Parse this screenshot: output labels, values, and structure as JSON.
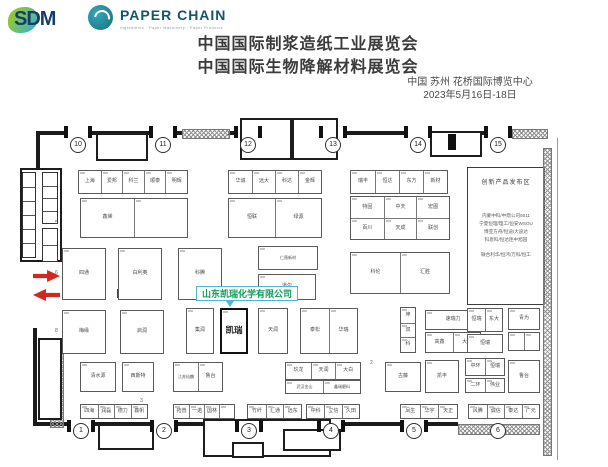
{
  "header": {
    "logo_sdm": {
      "text": "SDM"
    },
    "logo_paperchain": {
      "name": "PAPER CHAIN",
      "tagline": "Ingredients · Paper Machinery · Paper Products"
    },
    "title_line1": "中国国际制浆造纸工业展览会",
    "title_line2": "中国国际生物降解材料展览会",
    "venue": "中国 苏州 花桥国际博览中心",
    "dates": "2023年5月16日-18日"
  },
  "floorplan": {
    "highlight": {
      "callout": "山东凯瑞化学有限公司",
      "booth": "凯瑞",
      "accent_border": "#4fb6d9",
      "accent_text": "#0e9d58",
      "arrow_color": "#d2281e"
    },
    "launch_area": {
      "title": "创新产品发布区",
      "lines": [
        "内蒙中科/中鼎公司5011",
        "宁夏恒理/理工/恒安WSOU",
        "博亚方舟/恒迪/大迪达",
        "科恩科/恒达连中旭园",
        "联合利华/恒鸿/万科/恒工"
      ]
    },
    "gates_top": [
      {
        "n": "10",
        "x": 77
      },
      {
        "n": "11",
        "x": 162
      },
      {
        "n": "12",
        "x": 247
      },
      {
        "n": "13",
        "x": 332
      },
      {
        "n": "14",
        "x": 417
      },
      {
        "n": "15",
        "x": 497
      }
    ],
    "gates_bottom": [
      {
        "n": "1",
        "x": 80
      },
      {
        "n": "2",
        "x": 163
      },
      {
        "n": "3",
        "x": 248
      },
      {
        "n": "4",
        "x": 330
      },
      {
        "n": "5",
        "x": 413
      },
      {
        "n": "6",
        "x": 497
      }
    ],
    "gate_y_top": 34,
    "gate_y_bottom": 320,
    "walls": [
      [
        36,
        21,
        28,
        4
      ],
      [
        90,
        21,
        59,
        4
      ],
      [
        175,
        21,
        7,
        4
      ],
      [
        228,
        21,
        6,
        4
      ],
      [
        260,
        21,
        59,
        4
      ],
      [
        345,
        21,
        59,
        4
      ],
      [
        430,
        21,
        54,
        4
      ],
      [
        36,
        21,
        4,
        102
      ],
      [
        33,
        218,
        4,
        98
      ],
      [
        36,
        312,
        31,
        4
      ],
      [
        93,
        312,
        57,
        4
      ],
      [
        176,
        312,
        59,
        4
      ],
      [
        261,
        312,
        56,
        4
      ],
      [
        343,
        312,
        57,
        4
      ],
      [
        426,
        312,
        32,
        4
      ]
    ],
    "hatches": [
      [
        182,
        19,
        46,
        8
      ],
      [
        512,
        19,
        34,
        8
      ],
      [
        458,
        314,
        80,
        9
      ],
      [
        543,
        38,
        7,
        306
      ],
      [
        50,
        242,
        12,
        74
      ]
    ],
    "rooms": [
      [
        96,
        23,
        52,
        28
      ],
      [
        240,
        8,
        52,
        42
      ],
      [
        292,
        8,
        46,
        42
      ],
      [
        430,
        21,
        52,
        26
      ],
      [
        98,
        314,
        56,
        26
      ],
      [
        203,
        309,
        128,
        38
      ],
      [
        232,
        332,
        32,
        16
      ],
      [
        283,
        319,
        58,
        22
      ],
      [
        20,
        58,
        42,
        94
      ],
      [
        38,
        228,
        24,
        82
      ]
    ],
    "cellstructs": [
      {
        "x": 22,
        "y": 62,
        "w": 14,
        "h": 86,
        "rows": 6
      },
      {
        "x": 42,
        "y": 62,
        "w": 16,
        "h": 52,
        "rows": 4
      },
      {
        "x": 42,
        "y": 118,
        "w": 16,
        "h": 34,
        "rows": 2
      }
    ],
    "top_pier_xs": [
      64,
      88,
      149,
      173,
      234,
      258,
      319,
      343,
      404,
      428,
      484,
      508
    ],
    "bottom_pier_xs": [
      67,
      91,
      150,
      174,
      235,
      259,
      317,
      341,
      400,
      424
    ],
    "blocks": [
      [
        448,
        24,
        8,
        16
      ]
    ],
    "tiny_squares": [
      [
        117,
        179,
        11,
        9
      ],
      [
        237,
        180,
        11,
        9
      ]
    ],
    "rowmarks": [
      {
        "x": 55,
        "y": 110,
        "t": "5"
      },
      {
        "x": 55,
        "y": 160,
        "t": "6"
      },
      {
        "x": 55,
        "y": 218,
        "t": "8"
      },
      {
        "x": 140,
        "y": 288,
        "t": "3"
      },
      {
        "x": 370,
        "y": 250,
        "t": "2"
      }
    ],
    "booths": [
      {
        "x": 78,
        "y": 60,
        "w": 110,
        "h": 24,
        "cols": 5,
        "labels": [
          "上海",
          "爱邦",
          "科兰",
          "顺泰",
          "明辉"
        ]
      },
      {
        "x": 228,
        "y": 60,
        "w": 94,
        "h": 24,
        "cols": 4,
        "labels": [
          "华诚",
          "远大",
          "科达",
          "金辉"
        ]
      },
      {
        "x": 350,
        "y": 60,
        "w": 98,
        "h": 24,
        "cols": 4,
        "labels": [
          "瑞丰",
          "恒达",
          "东方",
          "新材"
        ]
      },
      {
        "x": 80,
        "y": 88,
        "w": 108,
        "h": 40,
        "cols": 2,
        "labels": [
          "鑫烯",
          ""
        ]
      },
      {
        "x": 228,
        "y": 88,
        "w": 94,
        "h": 40,
        "cols": 2,
        "labels": [
          "恒联",
          "绿源"
        ]
      },
      {
        "x": 350,
        "y": 86,
        "w": 100,
        "h": 44,
        "cols": 3,
        "rows": 2,
        "labels": [
          "特固",
          "中天",
          "宏图",
          "百川",
          "天成",
          "联创"
        ]
      },
      {
        "x": 62,
        "y": 138,
        "w": 44,
        "h": 52,
        "labels": [
          "四通"
        ]
      },
      {
        "x": 118,
        "y": 138,
        "w": 44,
        "h": 52,
        "labels": [
          "白利奥"
        ]
      },
      {
        "x": 178,
        "y": 138,
        "w": 44,
        "h": 52,
        "labels": [
          "科腾"
        ]
      },
      {
        "x": 258,
        "y": 136,
        "w": 60,
        "h": 24,
        "labels": [
          "仁薇新材"
        ]
      },
      {
        "x": 258,
        "y": 164,
        "w": 58,
        "h": 26,
        "labels": [
          "道尔"
        ]
      },
      {
        "x": 350,
        "y": 142,
        "w": 100,
        "h": 42,
        "cols": 2,
        "labels": [
          "科伦",
          "汇胜"
        ]
      },
      {
        "x": 62,
        "y": 200,
        "w": 44,
        "h": 44,
        "labels": [
          "梅缘"
        ]
      },
      {
        "x": 120,
        "y": 200,
        "w": 44,
        "h": 44,
        "labels": [
          "启润"
        ]
      },
      {
        "x": 186,
        "y": 198,
        "w": 28,
        "h": 46,
        "labels": [
          "集润"
        ]
      },
      {
        "x": 220,
        "y": 198,
        "w": 28,
        "h": 46,
        "bold": true,
        "labels": [
          "凯瑞"
        ]
      },
      {
        "x": 258,
        "y": 198,
        "w": 30,
        "h": 46,
        "labels": [
          "天润"
        ]
      },
      {
        "x": 300,
        "y": 198,
        "w": 58,
        "h": 46,
        "cols": 2,
        "labels": [
          "泰松",
          "华瑞"
        ]
      },
      {
        "x": 400,
        "y": 197,
        "w": 16,
        "h": 46,
        "rows": 3,
        "labels": [
          "坤",
          "双",
          "科"
        ]
      },
      {
        "x": 425,
        "y": 200,
        "w": 56,
        "h": 20,
        "labels": [
          "速瑞力"
        ]
      },
      {
        "x": 425,
        "y": 222,
        "w": 56,
        "h": 21,
        "cols": 2,
        "labels": [
          "高鑫",
          "大连"
        ]
      },
      {
        "x": 467,
        "y": 198,
        "w": 36,
        "h": 24,
        "cols": 2,
        "labels": [
          "恒瑞",
          "东大"
        ]
      },
      {
        "x": 467,
        "y": 224,
        "w": 36,
        "h": 19,
        "labels": [
          "恒瑞"
        ]
      },
      {
        "x": 508,
        "y": 198,
        "w": 32,
        "h": 22,
        "labels": [
          "青为"
        ]
      },
      {
        "x": 508,
        "y": 222,
        "w": 32,
        "h": 19,
        "cols": 2,
        "labels": [
          "",
          ""
        ]
      },
      {
        "x": 80,
        "y": 252,
        "w": 36,
        "h": 30,
        "labels": [
          "清水源"
        ]
      },
      {
        "x": 122,
        "y": 252,
        "w": 32,
        "h": 30,
        "labels": [
          "西斯特"
        ]
      },
      {
        "x": 173,
        "y": 252,
        "w": 50,
        "h": 30,
        "cols": 2,
        "labels": [
          "江苏仙麟",
          "鲁台"
        ]
      },
      {
        "x": 285,
        "y": 252,
        "w": 76,
        "h": 18,
        "cols": 3,
        "labels": [
          "玖龙",
          "天润",
          "大白"
        ]
      },
      {
        "x": 285,
        "y": 270,
        "w": 76,
        "h": 14,
        "cols": 2,
        "labels": [
          "武汉金山",
          "鑫瑞磨料"
        ]
      },
      {
        "x": 385,
        "y": 252,
        "w": 36,
        "h": 30,
        "labels": [
          "古藤"
        ]
      },
      {
        "x": 425,
        "y": 250,
        "w": 34,
        "h": 33,
        "labels": [
          "凯丰"
        ]
      },
      {
        "x": 465,
        "y": 248,
        "w": 40,
        "h": 18,
        "cols": 2,
        "labels": [
          "中环",
          "恒瑞"
        ]
      },
      {
        "x": 465,
        "y": 268,
        "w": 40,
        "h": 15,
        "cols": 2,
        "labels": [
          "二环",
          "伟业"
        ]
      },
      {
        "x": 508,
        "y": 250,
        "w": 32,
        "h": 33,
        "labels": [
          "鲁台"
        ]
      },
      {
        "x": 80,
        "y": 294,
        "w": 68,
        "h": 15,
        "cols": 4,
        "labels": [
          "四海",
          "润磊",
          "德力",
          "鑫帆"
        ]
      },
      {
        "x": 173,
        "y": 294,
        "w": 62,
        "h": 15,
        "cols": 4,
        "labels": [
          "拓普",
          "一诺",
          "国林",
          ""
        ]
      },
      {
        "x": 247,
        "y": 294,
        "w": 55,
        "h": 15,
        "cols": 3,
        "labels": [
          "竹纤",
          "汇通",
          "远东"
        ]
      },
      {
        "x": 306,
        "y": 294,
        "w": 54,
        "h": 15,
        "cols": 3,
        "labels": [
          "中科",
          "立信",
          "久田"
        ]
      },
      {
        "x": 400,
        "y": 294,
        "w": 58,
        "h": 15,
        "cols": 3,
        "labels": [
          "凤生",
          "华宇",
          "天正"
        ]
      },
      {
        "x": 468,
        "y": 294,
        "w": 72,
        "h": 15,
        "cols": 4,
        "labels": [
          "风腾",
          "诚信",
          "泰达",
          "广元"
        ]
      }
    ]
  }
}
